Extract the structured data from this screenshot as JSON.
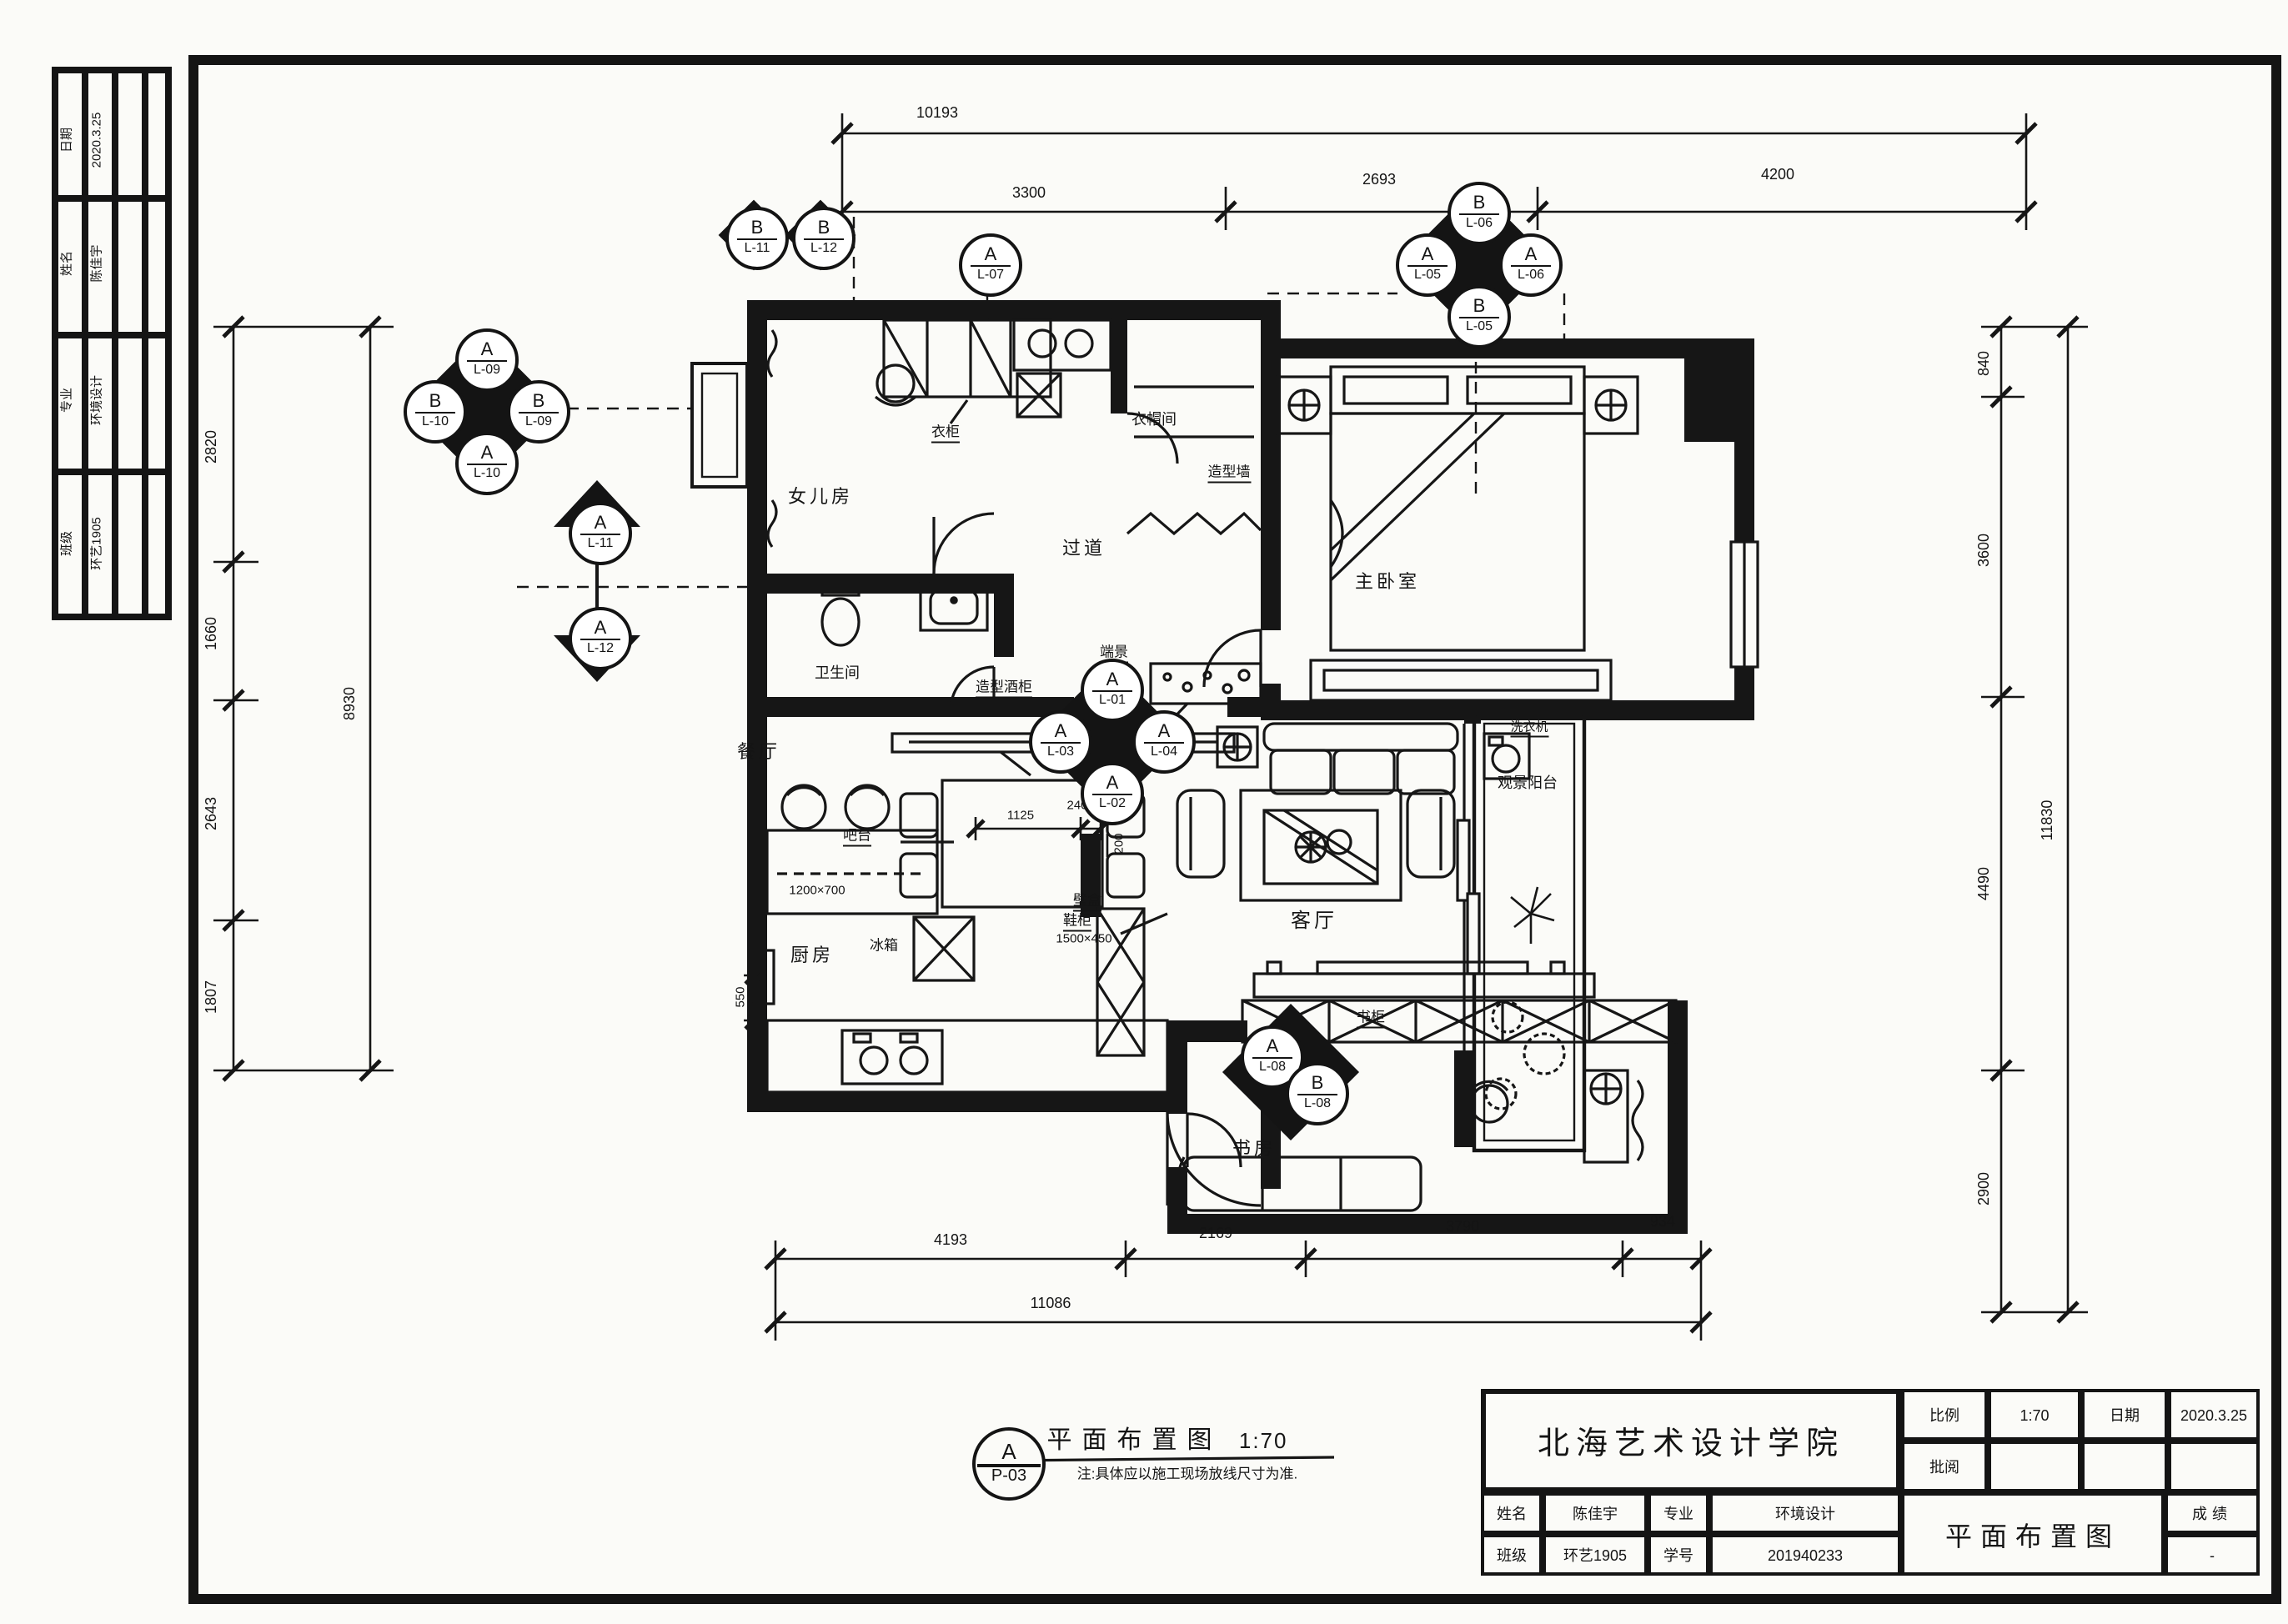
{
  "sheet": {
    "kind": "hand-drawn interior floor plan"
  },
  "edge_strip": {
    "rows": [
      {
        "label": "日期",
        "value": "2020.3.25"
      },
      {
        "label": "姓名",
        "value": "陈佳宇"
      },
      {
        "label": "专业",
        "value": "环境设计"
      },
      {
        "label": "班级",
        "value": "环艺1905"
      }
    ]
  },
  "dims": {
    "top": {
      "total": "10193",
      "segments": [
        "3300",
        "2693",
        "4200"
      ]
    },
    "left": {
      "total": "8930",
      "segments": [
        "2820",
        "1660",
        "2643",
        "1807"
      ]
    },
    "right": {
      "total": "11830",
      "segments": [
        "840",
        "3600",
        "4490",
        "2900"
      ]
    },
    "bottom": {
      "total": "11086",
      "segments": [
        "4193",
        "2169",
        "3790",
        "934"
      ]
    },
    "detail": {
      "d1125": "1125",
      "d240": "240",
      "d200": "200",
      "d550": "550",
      "bar_size": "1200×700",
      "shoe_size": "1500×450"
    }
  },
  "rooms": {
    "daughter": "女儿房",
    "cloak": "衣帽间",
    "hall": "过道",
    "bath": "卫生间",
    "master": "主卧室",
    "dining": "餐厅",
    "living": "客厅",
    "kitchen": "厨房",
    "study": "书房",
    "balcony": "观景阳台"
  },
  "fixtures": {
    "wardrobe": "衣柜",
    "feature_wall": "造型墙",
    "end_view": "端景",
    "wine_cabinet": "造型酒柜",
    "bar": "吧台",
    "fridge": "冰箱",
    "wall_box": "壁盒",
    "shoe_cabinet": "鞋柜",
    "washer": "洗衣机",
    "bookcase": "书柜"
  },
  "markers": {
    "pair_top_left": [
      {
        "letter": "B",
        "code": "L-11"
      },
      {
        "letter": "B",
        "code": "L-12"
      }
    ],
    "single_top": {
      "letter": "A",
      "code": "L-07"
    },
    "cluster_top_right": {
      "top": {
        "letter": "B",
        "code": "L-06"
      },
      "left": {
        "letter": "A",
        "code": "L-05"
      },
      "right": {
        "letter": "A",
        "code": "L-06"
      },
      "bottom": {
        "letter": "B",
        "code": "L-05"
      }
    },
    "cluster_left": {
      "top": {
        "letter": "A",
        "code": "L-09"
      },
      "left": {
        "letter": "B",
        "code": "L-10"
      },
      "right": {
        "letter": "B",
        "code": "L-09"
      },
      "bottom": {
        "letter": "A",
        "code": "L-10"
      }
    },
    "singles_left": [
      {
        "letter": "A",
        "code": "L-11"
      },
      {
        "letter": "A",
        "code": "L-12"
      }
    ],
    "cluster_center": {
      "top": {
        "letter": "A",
        "code": "L-01"
      },
      "left": {
        "letter": "A",
        "code": "L-03"
      },
      "right": {
        "letter": "A",
        "code": "L-04"
      },
      "bottom": {
        "letter": "A",
        "code": "L-02"
      }
    },
    "pair_study": [
      {
        "letter": "A",
        "code": "L-08"
      },
      {
        "letter": "B",
        "code": "L-08"
      }
    ]
  },
  "plan_label": {
    "bubble_letter": "A",
    "bubble_code": "P-03",
    "title": "平面布置图",
    "scale": "1:70",
    "note": "注:具体应以施工现场放线尺寸为准."
  },
  "title_block": {
    "school": "北海艺术设计学院",
    "scale_label": "比例",
    "scale_value": "1:70",
    "date_label": "日期",
    "date_value": "2020.3.25",
    "review_label": "批阅",
    "name_label": "姓名",
    "name_value": "陈佳宇",
    "major_label": "专业",
    "major_value": "环境设计",
    "class_label": "班级",
    "class_value": "环艺1905",
    "sid_label": "学号",
    "sid_value": "201940233",
    "drawing_title": "平面布置图",
    "grade_label": "成绩",
    "grade_value": "-"
  }
}
